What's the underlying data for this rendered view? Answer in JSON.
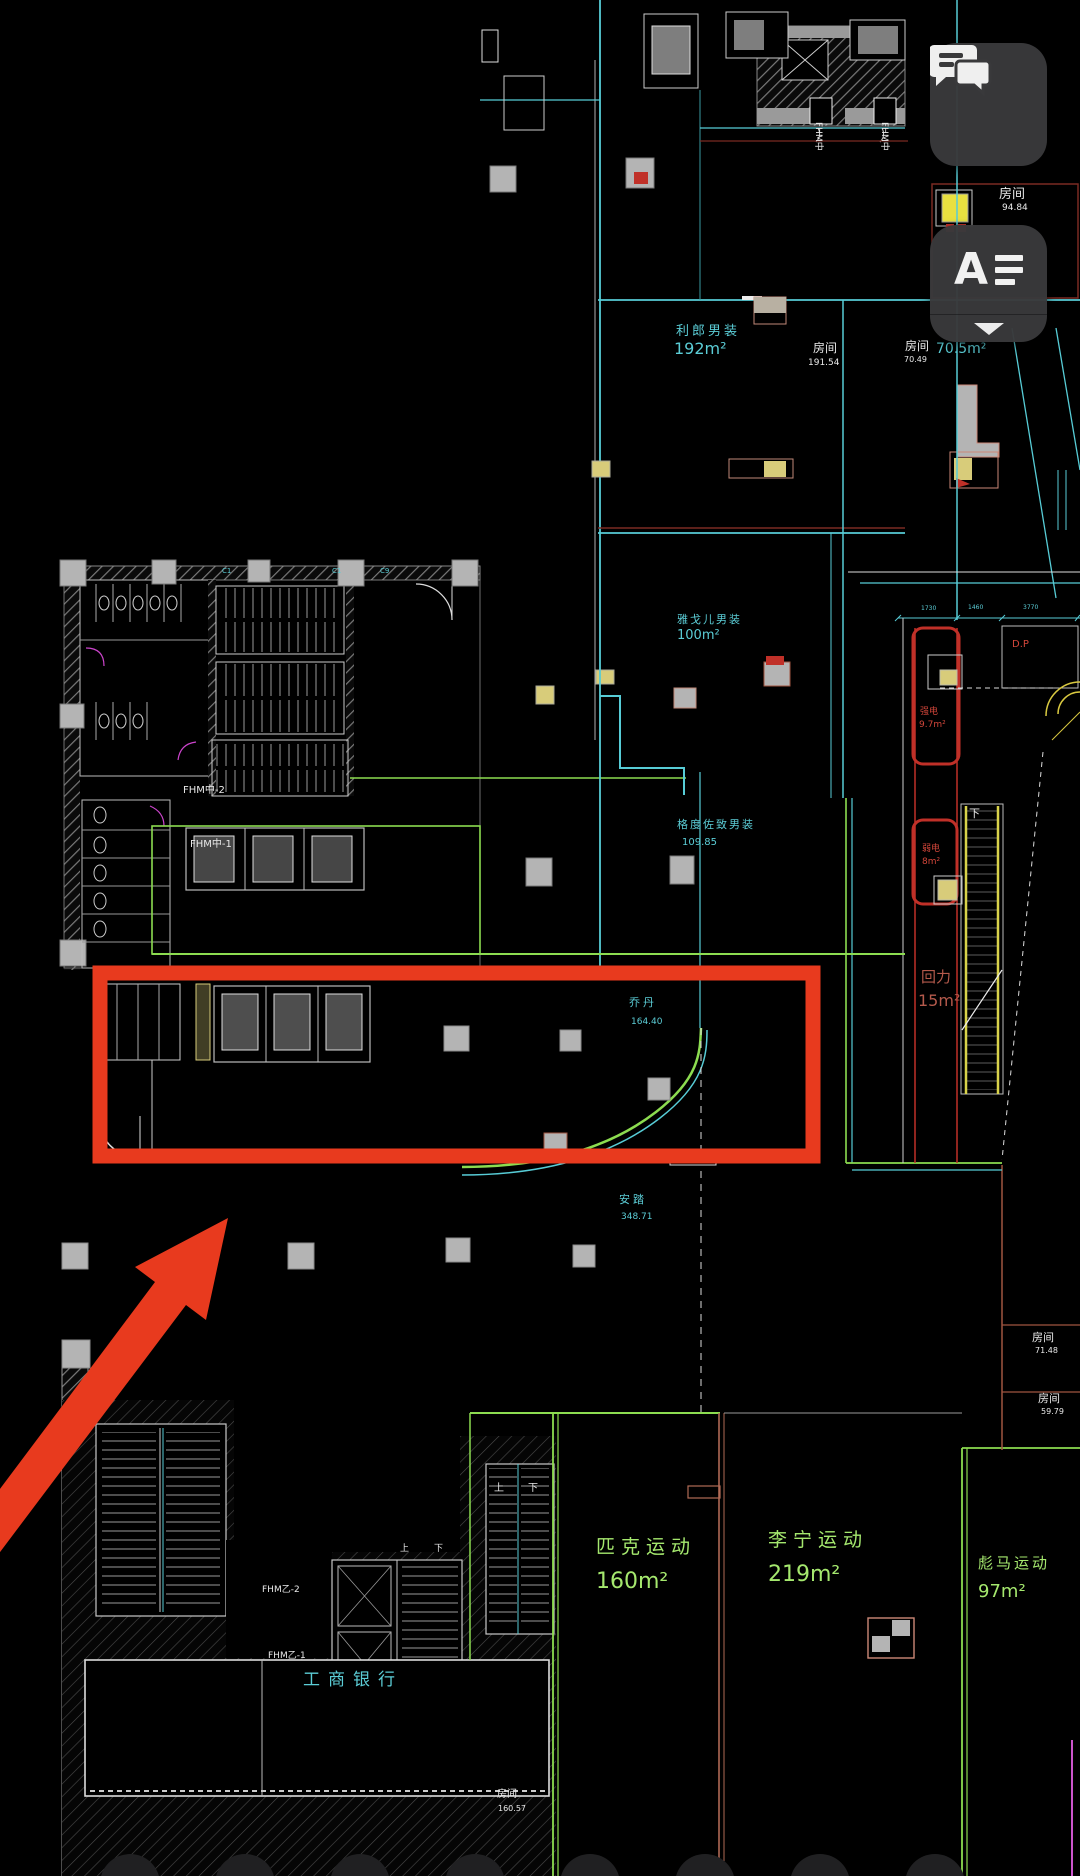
{
  "toolbar": {
    "comments_button": {
      "icon": "chat-bubbles-icon"
    },
    "annotation_button": {
      "letter": "A",
      "icon": "text-lines-icon",
      "chevron_icon": "chevron-down-icon"
    }
  },
  "plan": {
    "room_top": {
      "name": "房间",
      "area": "94.84"
    },
    "lilang": {
      "name": "利郎男装",
      "area": "192m²"
    },
    "room_191": {
      "name": "房间",
      "area": "191.54"
    },
    "room_70": {
      "name": "房间",
      "area": "70.49",
      "area_label": "70.5m²"
    },
    "youngor": {
      "name": "雅戈儿男装",
      "area": "100m²"
    },
    "gedu": {
      "name": "格度佐致男装",
      "area": "109.85"
    },
    "qiangdian": {
      "name": "强电",
      "area": "9.7m²"
    },
    "ruodian": {
      "name": "弱电",
      "area": "8m²"
    },
    "dp": {
      "name": "D.P"
    },
    "qiaodan": {
      "name": "乔丹",
      "area": "164.40"
    },
    "huili": {
      "name": "回力",
      "area": "15m²"
    },
    "anta": {
      "name": "安踏",
      "area": "348.71"
    },
    "room_7148": {
      "name": "房间",
      "area": "71.48"
    },
    "room_5979": {
      "name": "房间",
      "area": "59.79"
    },
    "pike": {
      "name": "匹克运动",
      "area": "160m²"
    },
    "lining": {
      "name": "李宁运动",
      "area": "219m²"
    },
    "puma": {
      "name": "彪马运动",
      "area": "97m²"
    },
    "icbc": {
      "name": "工商银行"
    },
    "room_160": {
      "name": "房间",
      "area": "160.57"
    },
    "fhm": {
      "mid2": "FHM中-2",
      "mid1": "FHM中-1",
      "yi1": "FHM乙-1",
      "yi2": "FHM乙-2",
      "riser": "FHM中"
    },
    "stairs": {
      "up": "上",
      "down": "下"
    },
    "grid_axis": {
      "c1": "C1",
      "c9": "C9"
    },
    "dims": {
      "d1": "1730",
      "d2": "1460",
      "d3": "3770"
    }
  },
  "colors": {
    "annotation_red": "#e83a1e",
    "wall_cyan": "#57ccd6",
    "shop_green": "#9ae05c",
    "cad_red": "#c9372c",
    "button_bg": "#39393b"
  }
}
